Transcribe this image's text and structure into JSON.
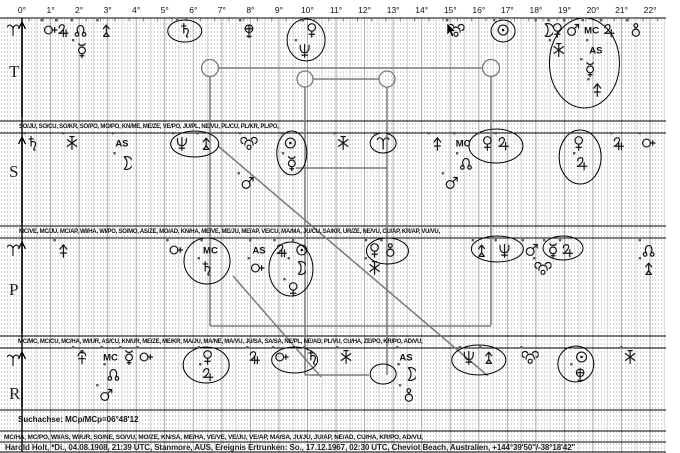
{
  "scale": {
    "x0": 22,
    "px_per_deg": 28.55,
    "deg_labels": [
      "0°",
      "1°",
      "2°",
      "3°",
      "4°",
      "5°",
      "6°",
      "7°",
      "8°",
      "9°",
      "10°",
      "11°",
      "12°",
      "13°",
      "14°",
      "15°",
      "16°",
      "17°",
      "18°",
      "19°",
      "20°",
      "21°",
      "22°"
    ],
    "right_edge_deg": 22.5
  },
  "rows": [
    {
      "id": "T",
      "label": "T",
      "label_y": 77,
      "band_top": 19,
      "band_bottom": 119,
      "levels": [
        30,
        50,
        69,
        89
      ],
      "axis_ram": true,
      "glyphs": [
        [
          "cupido",
          1.0,
          0
        ],
        [
          "apollon",
          1.5,
          0
        ],
        [
          "node",
          2.05,
          0
        ],
        [
          "mercury",
          2.1,
          1
        ],
        [
          "zeus",
          2.95,
          0
        ],
        [
          "saturn",
          5.75,
          0
        ],
        [
          "admetos",
          7.95,
          0
        ],
        [
          "neptune",
          9.9,
          1
        ],
        [
          "venus",
          10.15,
          0
        ],
        [
          "poseidon",
          15.2,
          0
        ],
        [
          "sun",
          16.85,
          0
        ],
        [
          "moon",
          18.3,
          0
        ],
        [
          "venus",
          18.75,
          0
        ],
        [
          "hades",
          18.8,
          1
        ],
        [
          "mars",
          19.3,
          0
        ],
        [
          "mercury",
          19.9,
          2
        ],
        [
          "MC",
          19.95,
          0
        ],
        [
          "AS",
          20.1,
          1
        ],
        [
          "vulkanus",
          20.15,
          3
        ],
        [
          "jupiter",
          20.6,
          0
        ],
        [
          "ballring",
          21.5,
          0
        ]
      ],
      "rings": [
        [
          5.7,
          31,
          17,
          11
        ],
        [
          9.95,
          40,
          19,
          21
        ],
        [
          16.85,
          31,
          12,
          11
        ],
        [
          19.7,
          63,
          35,
          45
        ]
      ]
    },
    {
      "id": "S",
      "label": "S",
      "label_y": 177,
      "band_top": 134,
      "band_bottom": 225,
      "levels": [
        143,
        163,
        183
      ],
      "axis_ram": false,
      "glyphs": [
        [
          "saturn",
          0.4,
          0
        ],
        [
          "hades",
          1.75,
          0
        ],
        [
          "AS",
          3.5,
          0
        ],
        [
          "moon",
          3.55,
          1
        ],
        [
          "neptune",
          5.6,
          0
        ],
        [
          "zeus",
          6.45,
          0
        ],
        [
          "poseidon",
          7.95,
          0
        ],
        [
          "mars",
          7.9,
          2
        ],
        [
          "sun",
          9.4,
          0
        ],
        [
          "mercury",
          9.45,
          1
        ],
        [
          "hades",
          11.25,
          0
        ],
        [
          "aries",
          12.65,
          0
        ],
        [
          "vulkanus",
          14.55,
          0
        ],
        [
          "mars",
          15.05,
          2
        ],
        [
          "MC",
          15.45,
          0
        ],
        [
          "node",
          15.55,
          1
        ],
        [
          "venus",
          16.3,
          0
        ],
        [
          "jupiter",
          16.9,
          0
        ],
        [
          "venus",
          19.5,
          0
        ],
        [
          "jupiter",
          19.65,
          1
        ],
        [
          "apollon",
          20.95,
          0
        ],
        [
          "cupido",
          21.95,
          0
        ]
      ],
      "rings": [
        [
          6.05,
          144,
          24,
          13
        ],
        [
          9.45,
          153,
          15,
          22
        ],
        [
          12.65,
          143,
          13,
          10
        ],
        [
          16.6,
          146,
          27,
          17
        ],
        [
          19.55,
          157,
          21,
          27
        ]
      ]
    },
    {
      "id": "P",
      "label": "P",
      "label_y": 295,
      "band_top": 239,
      "band_bottom": 335,
      "levels": [
        250,
        268,
        289
      ],
      "axis_ram": true,
      "glyphs": [
        [
          "vulkanus",
          1.45,
          0
        ],
        [
          "cupido",
          5.4,
          0
        ],
        [
          "MC",
          6.6,
          0
        ],
        [
          "saturn",
          6.5,
          1
        ],
        [
          "AS",
          8.3,
          0
        ],
        [
          "cupido",
          8.25,
          1
        ],
        [
          "apollon",
          9.15,
          0
        ],
        [
          "sun",
          9.8,
          0
        ],
        [
          "moon",
          9.65,
          1
        ],
        [
          "venus",
          9.5,
          2
        ],
        [
          "venus",
          12.35,
          0
        ],
        [
          "ballring",
          12.9,
          0
        ],
        [
          "hades",
          12.35,
          1
        ],
        [
          "zeus",
          16.1,
          0
        ],
        [
          "neptune",
          16.9,
          0
        ],
        [
          "mars",
          17.85,
          0
        ],
        [
          "poseidon",
          18.25,
          1
        ],
        [
          "mercury",
          18.6,
          0
        ],
        [
          "jupiter",
          19.15,
          0
        ],
        [
          "node",
          21.95,
          0
        ],
        [
          "zeus",
          21.95,
          1
        ]
      ],
      "rings": [
        [
          6.48,
          261,
          23,
          23
        ],
        [
          9.42,
          269,
          22,
          27
        ],
        [
          12.8,
          251,
          21,
          13
        ],
        [
          16.65,
          249,
          26,
          13
        ],
        [
          18.95,
          248,
          20,
          12
        ]
      ]
    },
    {
      "id": "R",
      "label": "R",
      "label_y": 399,
      "band_top": 349,
      "band_bottom": 409,
      "levels": [
        357,
        374,
        395
      ],
      "axis_ram": true,
      "glyphs": [
        [
          "kronos",
          2.1,
          0
        ],
        [
          "mars",
          2.95,
          2
        ],
        [
          "MC",
          3.1,
          0
        ],
        [
          "node",
          3.2,
          1
        ],
        [
          "mercury",
          3.75,
          0
        ],
        [
          "cupido",
          4.35,
          0
        ],
        [
          "venus",
          6.5,
          0
        ],
        [
          "jupiter",
          6.55,
          1
        ],
        [
          "apollon",
          8.2,
          0
        ],
        [
          "cupido",
          9.1,
          0
        ],
        [
          "saturn",
          10.2,
          0
        ],
        [
          "hades",
          11.35,
          0
        ],
        [
          "AS",
          13.45,
          0
        ],
        [
          "moon",
          13.5,
          1
        ],
        [
          "ballring",
          13.55,
          2
        ],
        [
          "neptune",
          15.65,
          0
        ],
        [
          "zeus",
          16.35,
          0
        ],
        [
          "poseidon",
          17.8,
          0
        ],
        [
          "sun",
          19.6,
          0
        ],
        [
          "admetos",
          19.55,
          1
        ],
        [
          "hades",
          21.3,
          0
        ]
      ],
      "rings": [
        [
          6.45,
          365,
          23,
          18
        ],
        [
          9.55,
          360,
          23,
          13
        ],
        [
          12.65,
          374,
          13,
          10
        ],
        [
          16.0,
          360,
          27,
          15
        ],
        [
          19.4,
          364,
          18,
          18
        ]
      ]
    }
  ],
  "formula_lines": [
    {
      "x": 19,
      "y": 124,
      "text": "SO/JU, SO/CU, SO/KR, SO/PO, MO/PO, KN/ME, ME/ZE, VE/PO, JU/PL, NE/VU, PL/CU, PL/KR, PL/PO,"
    },
    {
      "x": 19,
      "y": 229,
      "text": "MC/VE, MC/JU, MC/AP, WI/HA, WI/PO, SO/MO, AS/ZE, MO/AD, KN/HA, ME/VE, ME/JU, ME/AP, VE/CU, MA/MA, JU/CU, SA/KR, UR/ZE, NE/VU, CU/AP, KR/AP, VU/VU,"
    },
    {
      "x": 18,
      "y": 339,
      "text": "MC/MC, MC/CU, MC/HA, WI/UR, AS/CU, KN/UR, ME/ZE, ME/KR, MA/JU, MA/NE, MA/VU, JU/SA, SA/SA, NE/PL, NE/AD, PL/VU, CU/HA, ZE/PO, KR/PO, AD/VU,"
    }
  ],
  "footer": {
    "search_axis": "Suchachse: MCp/MCp=06°48'12",
    "midpoints": "MC/HA, MC/PO, WI/AS, WI/UR, SO/NE, SO/VU, MO/ZE, KN/SA, ME/HA, VE/VE, VE/JU, VE/AP, MA/SA, JU/JU, JU/AP, NE/AD, CU/HA, KR/PO, AD/VU,",
    "person": "Harold Holt, *Di., 04.08.1908, 21:39 UTC, Stanmore, AUS, Ereignis Ertrunken: So., 17.12.1967, 02:30 UTC, Cheviot Beach, Australien, +144°39'50\"/-38°18'42\""
  },
  "aspect": {
    "color": "#7b7b7b",
    "segments": [
      [
        219,
        68,
        483,
        68
      ],
      [
        210,
        77,
        210,
        326
      ],
      [
        491,
        77,
        491,
        325
      ],
      [
        210,
        326,
        491,
        326
      ],
      [
        313,
        79,
        379,
        79
      ],
      [
        305,
        87,
        305,
        375
      ],
      [
        387,
        87,
        387,
        375
      ],
      [
        305,
        375,
        369,
        375
      ],
      [
        296,
        168,
        387,
        168
      ],
      [
        218,
        146,
        488,
        376
      ],
      [
        233,
        276,
        321,
        377
      ]
    ],
    "circles": [
      [
        210,
        68,
        8.5
      ],
      [
        491,
        68,
        8.5
      ],
      [
        305,
        79,
        8
      ],
      [
        387,
        79,
        8
      ]
    ]
  },
  "separators": [
    18,
    121,
    133,
    226,
    238,
    336,
    348,
    410,
    431,
    442,
    452
  ],
  "cursor": {
    "x": 447,
    "y": 23
  }
}
